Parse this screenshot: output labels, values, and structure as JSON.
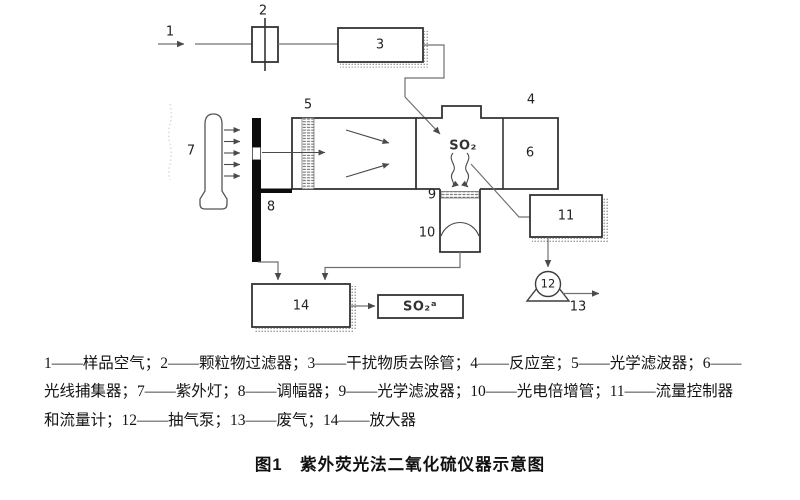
{
  "figure": {
    "caption": "图1　紫外荧光法二氧化硫仪器示意图",
    "legend": {
      "line1": "1——样品空气；2——颗粒物过滤器；3——干扰物质去除管；4——反应室；5——光学滤波器；6——",
      "line2": "光线捕集器；7——紫外灯；8——调幅器；9——光学滤波器；10——光电倍增管；11——流量控制器",
      "line3": "和流量计；12——抽气泵；13——废气；14——放大器"
    },
    "labels": {
      "l1": "1",
      "l2": "2",
      "l3": "3",
      "l4": "4",
      "l5": "5",
      "l6": "6",
      "l7": "7",
      "l8": "8",
      "l9": "9",
      "l10": "10",
      "l11": "11",
      "l12": "12",
      "l13": "13",
      "l14": "14",
      "so2_chamber": "SO₂",
      "so2_output": "SO₂ᵃ"
    },
    "colors": {
      "box_stroke": "#333333",
      "connector": "#707070",
      "modulator_fill": "#0c0c0c",
      "text": "#141414",
      "background": "#ffffff"
    }
  }
}
